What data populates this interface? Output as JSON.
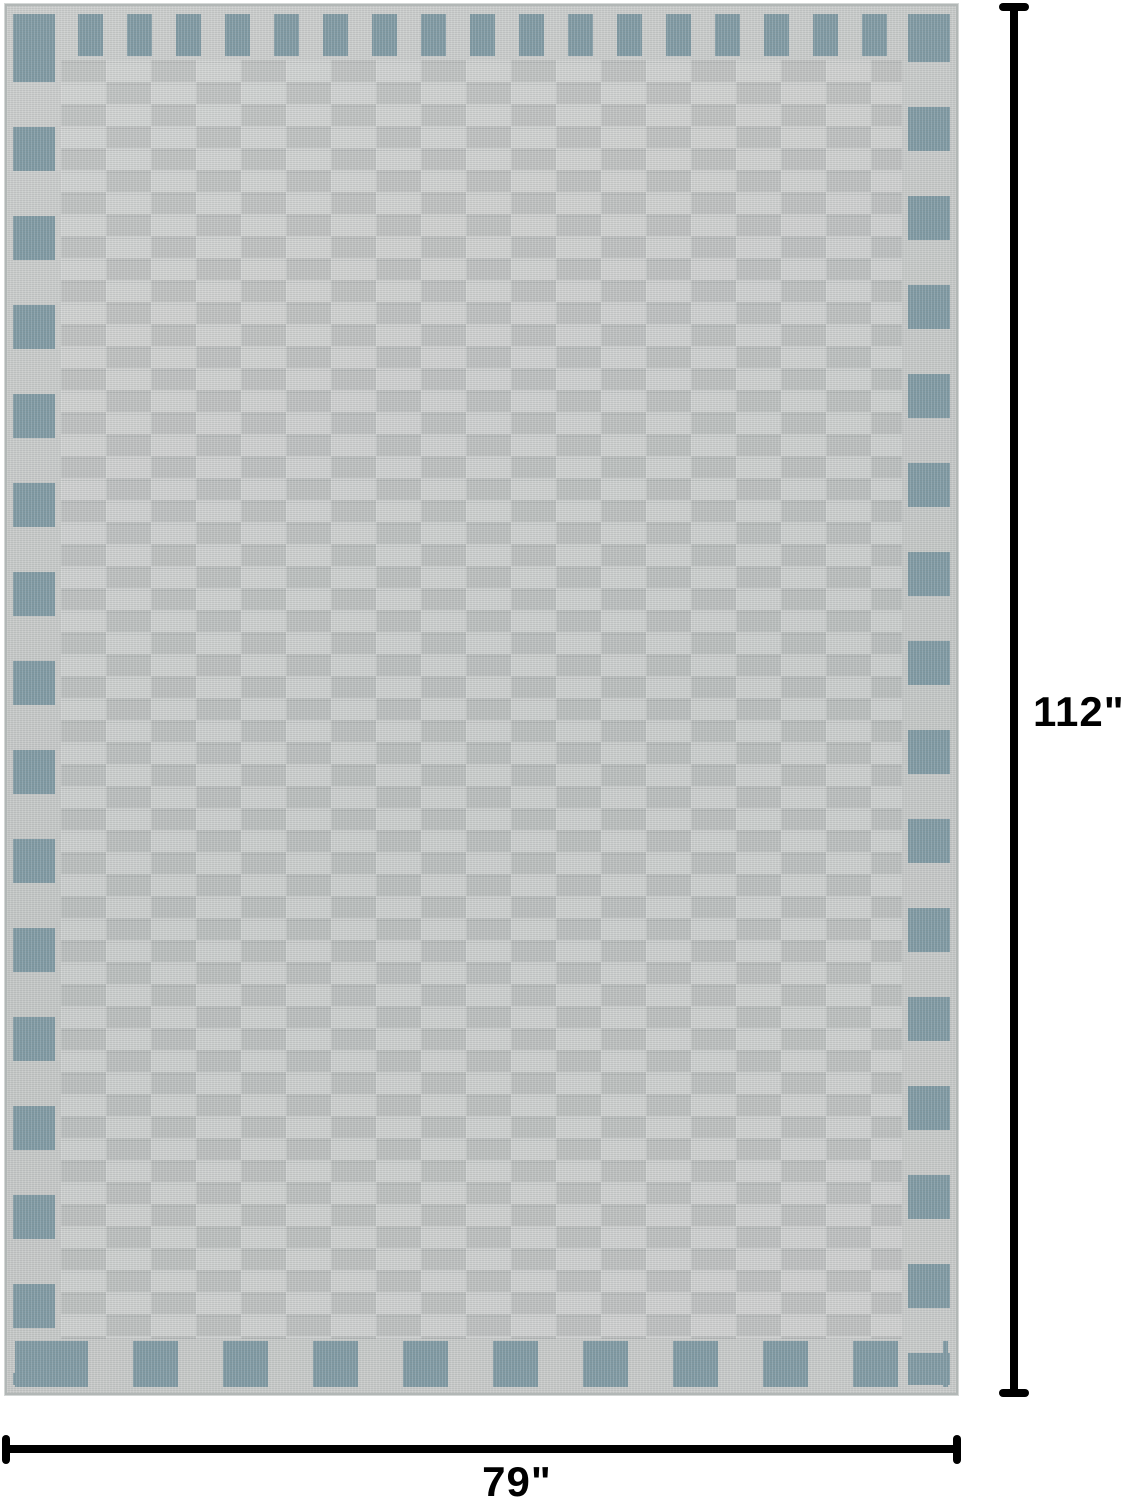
{
  "diagram": {
    "height_label": "112\"",
    "width_label": "79\""
  },
  "colors": {
    "background": "#ffffff",
    "dimension_line": "#000000",
    "rug_base": "#c7c9c8",
    "rug_accent": "#7f99a3",
    "rug_texture_dark": "#9aa0a0",
    "rug_edge": "#b2b7b6"
  }
}
